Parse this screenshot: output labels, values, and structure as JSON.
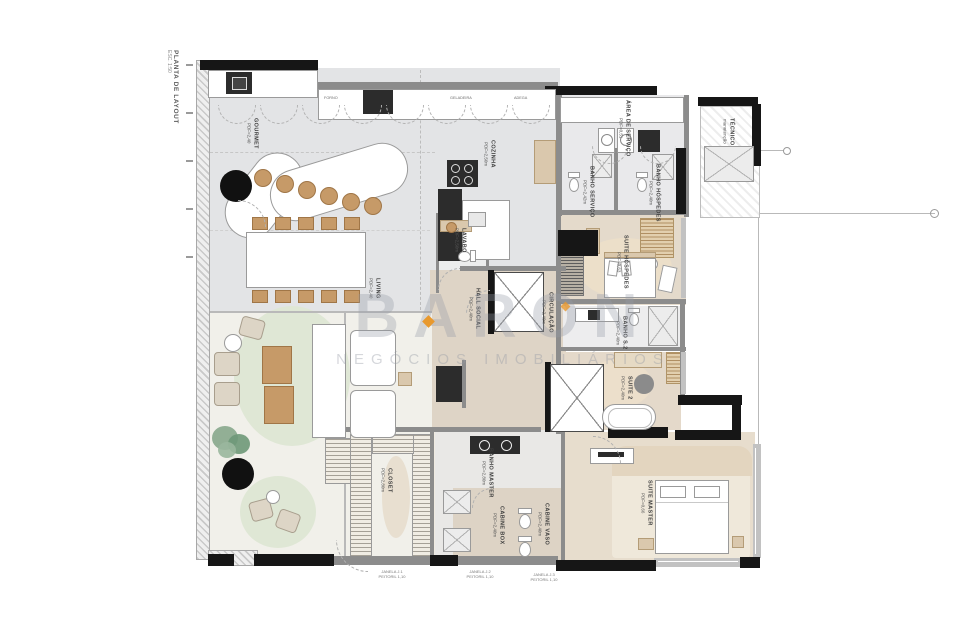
{
  "title": {
    "main": "PLANTA DE LAYOUT",
    "scale": "ESC. 1:50"
  },
  "watermark": {
    "brand": "BARON",
    "tagline": "NEGÓCIOS IMOBILIÁRIOS",
    "accent": "#E8992E"
  },
  "rooms": {
    "gourmet": {
      "label": "GOURMET",
      "pdf": "PDF=2,40"
    },
    "cozinha": {
      "label": "COZINHA",
      "pdf": "PDF=2,50m"
    },
    "area_servico": {
      "label": "ÁREA DE SERVIÇO",
      "pdf": "PDF=0,51"
    },
    "banho_servico": {
      "label": "BANHO SERVIÇO",
      "pdf": "PDF=2,42m"
    },
    "banho_hospedes": {
      "label": "BANHO HÓSPEDES",
      "pdf": "PDF=2,40m"
    },
    "suite_hospedes": {
      "label": "SUITE HÓSPEDES",
      "pdf": "PDF=0,63"
    },
    "tecnico": {
      "label": "TÉCNICO",
      "pdf": "manutenção"
    },
    "lavabo": {
      "label": "LAVABO",
      "pdf": "PDF=2,50m"
    },
    "hall_social": {
      "label": "HALL SOCIAL",
      "pdf": "PDF=2,40m"
    },
    "circulacao": {
      "label": "CIRCULAÇÃO",
      "pdf": "PDF=2,40m"
    },
    "living": {
      "label": "LIVING",
      "pdf": "PDF=2,40"
    },
    "banho_s2": {
      "label": "BANHO S.2",
      "pdf": "PDF=2,40m"
    },
    "suite_2": {
      "label": "SUITE 2",
      "pdf": "PDF=2,40m"
    },
    "closet": {
      "label": "CLOSET",
      "pdf": "PDF=2,80m"
    },
    "banho_master": {
      "label": "BANHO MASTER",
      "pdf": "PDF=2,80m"
    },
    "cabine_box": {
      "label": "CABINE BOX",
      "pdf": "PDF=2,40m"
    },
    "cabine_vaso": {
      "label": "CABINE VASO",
      "pdf": "PDF=2,40m"
    },
    "suite_master": {
      "label": "SUITE MASTER",
      "pdf": "PDF=0,66"
    }
  },
  "annotations": {
    "win1": {
      "l1": "JANELA J.1",
      "l2": "PEITORIL 1,10"
    },
    "win2": {
      "l1": "JANELA J.2",
      "l2": "PEITORIL 1,10"
    },
    "win3": {
      "l1": "JANELA J.3",
      "l2": "PEITORIL 1,10"
    },
    "appl1": "FORNO",
    "appl2": "GELADEIRA",
    "appl3": "ADEGA"
  },
  "colors": {
    "accent": "#E8992E",
    "floor_gray": "#E3E4E6",
    "floor_beige": "#E4DACB",
    "rug_green": "#DFE7D5",
    "wall_dark": "#161616"
  }
}
